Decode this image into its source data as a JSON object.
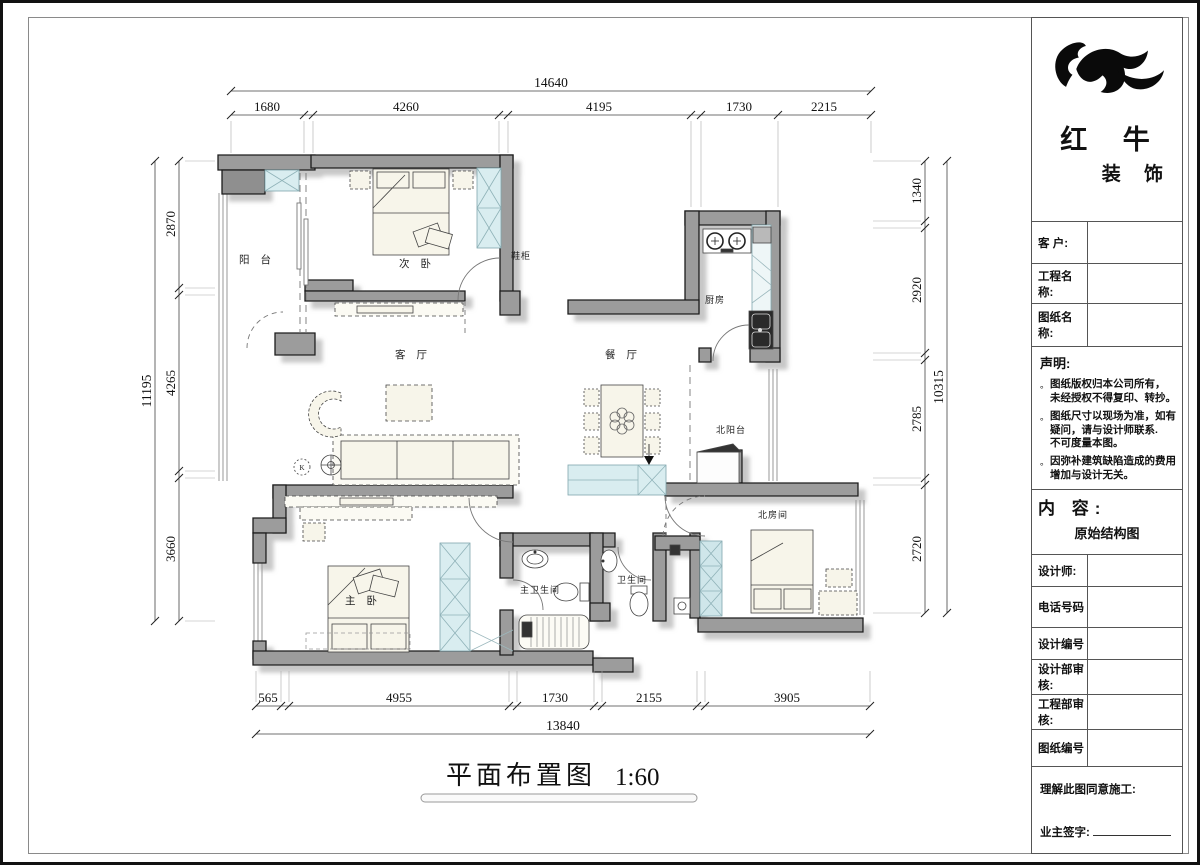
{
  "page": {
    "drawing_title": "平面布置图",
    "drawing_scale": "1:60"
  },
  "plan": {
    "rooms": {
      "balcony": "阳 台",
      "second_bedroom": "次 卧",
      "shoe_cabinet": "鞋柜",
      "living_room": "客 厅",
      "dining_room": "餐 厅",
      "kitchen": "厨房",
      "north_balcony": "北阳台",
      "north_room": "北房间",
      "master_bedroom": "主 卧",
      "master_bathroom": "主卫生间",
      "bathroom": "卫生间",
      "k_mark": "K"
    },
    "dims": {
      "top": {
        "total": "14640",
        "segs": [
          "1680",
          "4260",
          "4195",
          "1730",
          "2215"
        ]
      },
      "left": {
        "total": "11195",
        "segs": [
          "2870",
          "4265",
          "3660"
        ]
      },
      "right": {
        "total": "10315",
        "segs": [
          "1340",
          "2920",
          "2785",
          "2720"
        ]
      },
      "bottom": {
        "total": "13840",
        "segs": [
          "565",
          "4955",
          "1730",
          "2155",
          "3905"
        ]
      }
    }
  },
  "title_block": {
    "brand_line1": "红 牛",
    "brand_line2": "装 饰",
    "bullet": "。",
    "customer_label": "客  户:",
    "project_label": "工程名称:",
    "drawing_label": "图纸名称:",
    "statement_title": "声明:",
    "statement_items": [
      {
        "lines": [
          "图纸版权归本公司所有，",
          "未经授权不得复印、转抄。"
        ]
      },
      {
        "lines": [
          "图纸尺寸以现场为准，如有",
          "疑问，请与设计师联系.",
          "不可度量本图。"
        ]
      },
      {
        "lines": [
          "因弥补建筑缺陷造成的费用",
          "增加与设计无关。"
        ]
      }
    ],
    "content_label": "内  容:",
    "content_value": "原始结构图",
    "designer_label": "设计师:",
    "phone_label": "电话号码",
    "design_no_label": "设计编号",
    "design_review_label": "设计部审核:",
    "engineering_review_label": "工程部审核:",
    "drawing_no_label": "图纸编号",
    "agreement_label": "理解此图同意施工:",
    "owner_sign_label": "业主签字:"
  }
}
